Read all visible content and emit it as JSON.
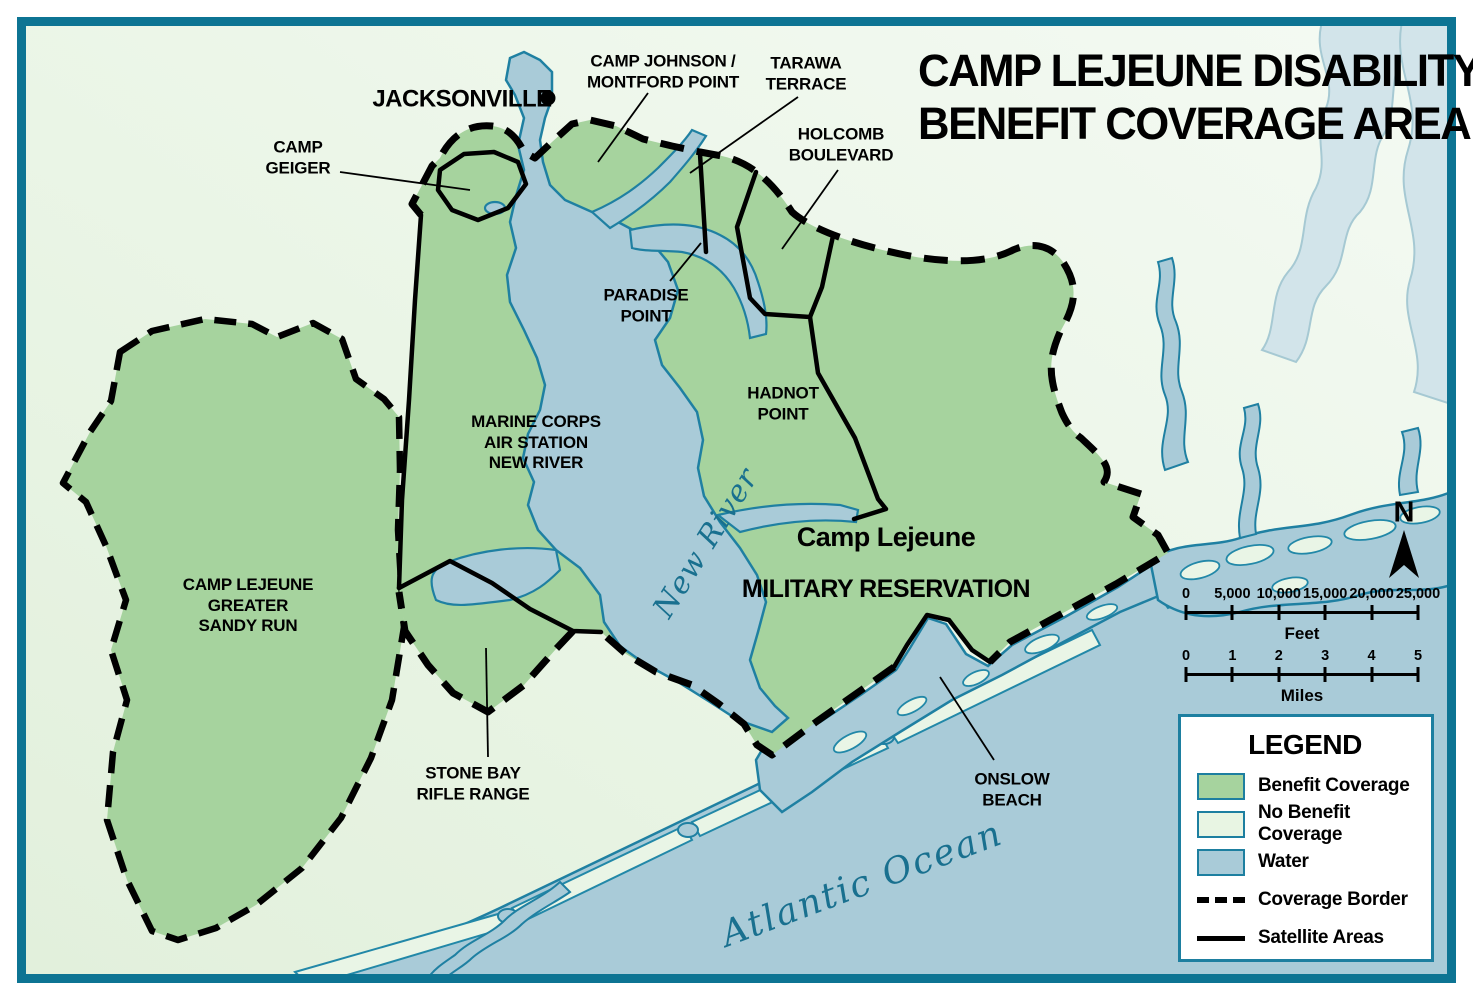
{
  "title": {
    "line1": "CAMP LEJEUNE DISABILITY",
    "line2": "BENEFIT COVERAGE AREA"
  },
  "labels": {
    "jacksonville": "JACKSONVILLE",
    "camp_johnson": "CAMP JOHNSON /\nMONTFORD POINT",
    "tarawa_terrace": "TARAWA\nTERRACE",
    "holcomb_boulevard": "HOLCOMB\nBOULEVARD",
    "camp_geiger": "CAMP\nGEIGER",
    "paradise_point": "PARADISE\nPOINT",
    "hadnot_point": "HADNOT\nPOINT",
    "mcas_new_river": "MARINE CORPS\nAIR STATION\nNEW RIVER",
    "military_reservation_line1": "Camp Lejeune",
    "military_reservation_line2": "MILITARY RESERVATION",
    "greater_sandy_run": "CAMP LEJEUNE\nGREATER\nSANDY RUN",
    "stone_bay": "STONE BAY\nRIFLE RANGE",
    "onslow_beach": "ONSLOW\nBEACH"
  },
  "water_labels": {
    "new_river": "New River",
    "atlantic_ocean": "Atlantic Ocean"
  },
  "north_indicator": {
    "label": "N"
  },
  "scale_bars": {
    "feet": {
      "ticks": [
        "0",
        "5,000",
        "10,000",
        "15,000",
        "20,000",
        "25,000"
      ],
      "unit": "Feet"
    },
    "miles": {
      "ticks": [
        "0",
        "1",
        "2",
        "3",
        "4",
        "5"
      ],
      "unit": "Miles"
    }
  },
  "legend": {
    "title": "LEGEND",
    "items": [
      {
        "label": "Benefit Coverage",
        "type": "swatch",
        "color": "#a6d39e"
      },
      {
        "label": "No Benefit Coverage",
        "type": "swatch",
        "color": "#e8f5e3"
      },
      {
        "label": "Water",
        "type": "swatch",
        "color": "#a9cbd8"
      },
      {
        "label": "Coverage Border",
        "type": "dashed-line",
        "color": "#000000"
      },
      {
        "label": "Satellite Areas",
        "type": "solid-line",
        "color": "#000000"
      }
    ]
  },
  "colors": {
    "benefit_coverage": "#a6d39e",
    "no_benefit_coverage": "#e8f5e3",
    "water": "#a9cbd8",
    "water_outline": "#1f80a2",
    "frame_border": "#0d7493",
    "water_label_text": "#19708f",
    "coverage_border": "#000000"
  }
}
